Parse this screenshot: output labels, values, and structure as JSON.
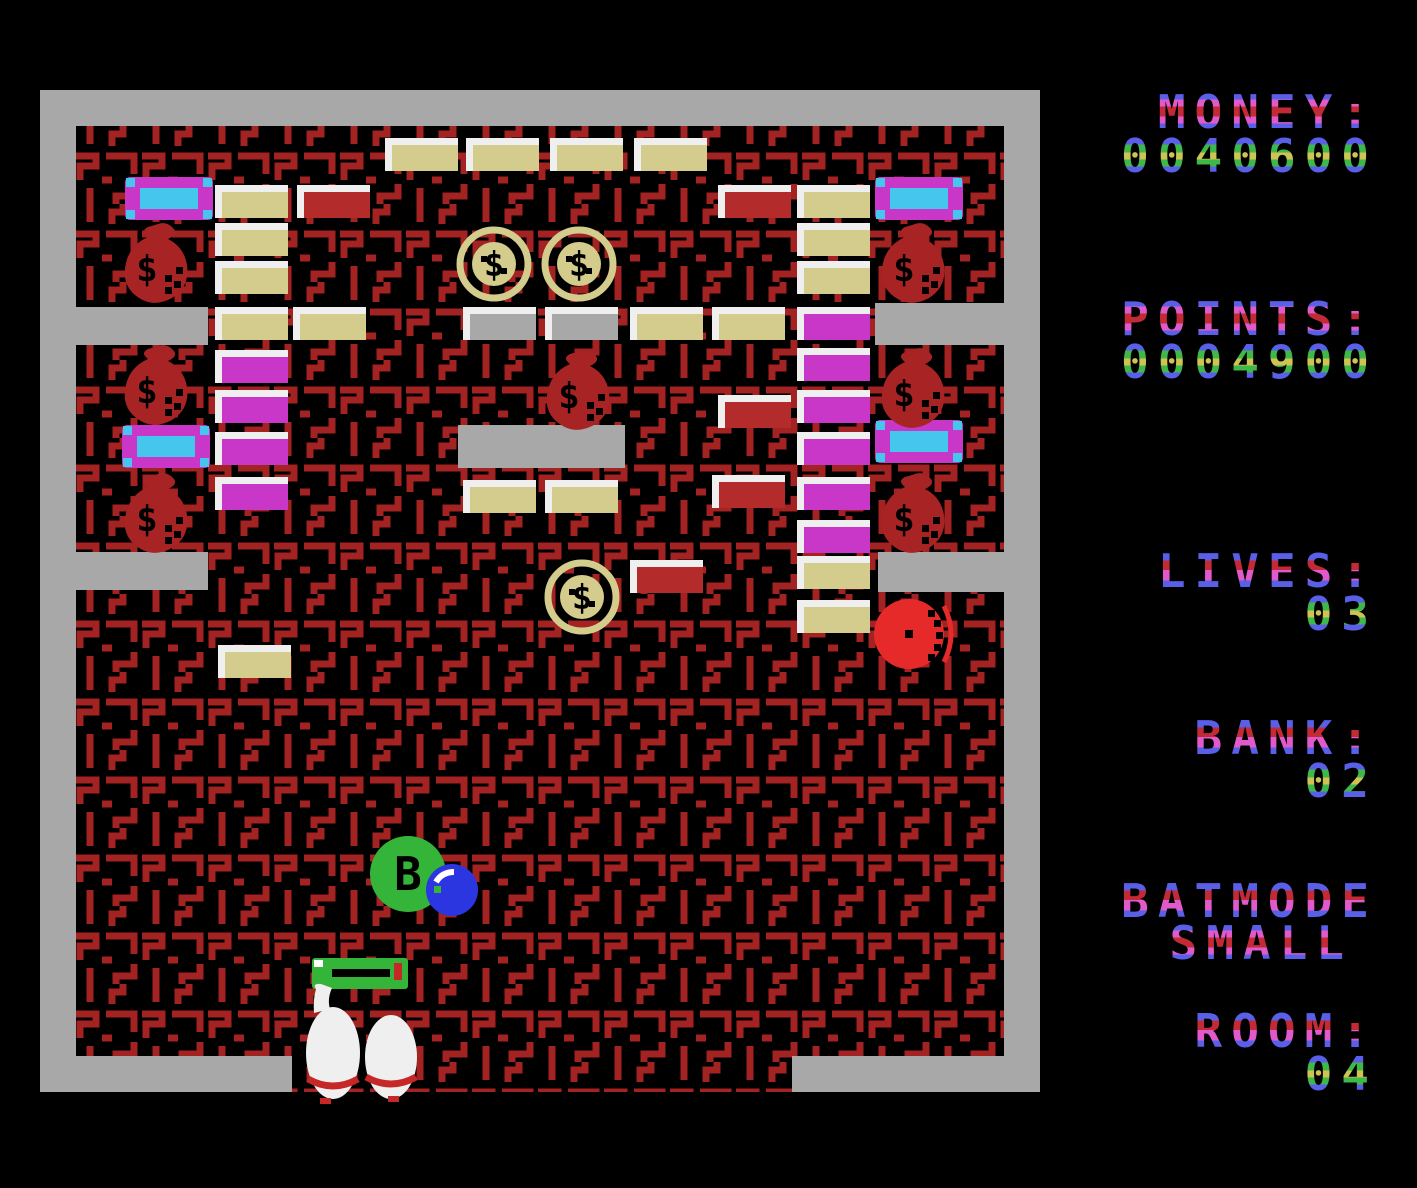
{
  "hud": {
    "money": {
      "label": "MONEY:",
      "value": "0040600"
    },
    "points": {
      "label": "POINTS:",
      "value": "0004900"
    },
    "lives": {
      "label": "LIVES:",
      "value": "03"
    },
    "bank": {
      "label": "BANK:",
      "value": "02"
    },
    "batmode": {
      "label": "BATMODE",
      "value": "SMALL"
    },
    "room": {
      "label": "ROOM:",
      "value": "04"
    }
  },
  "sprite_glyphs": {
    "coin_symbol": "$",
    "money_bag_symbol": "$",
    "bonus_ball_letter": "B"
  },
  "colors": {
    "background": "#000000",
    "wall_gray": "#A8A8A8",
    "maze_red": "#A32222",
    "brick_cream": "#D3CC8C",
    "brick_gray": "#A8A8A8",
    "brick_red": "#B32B2B",
    "brick_magenta": "#C837C8",
    "brick_highlight": "#EFEFEF",
    "sprite_dark_red": "#A82424",
    "sprite_bright_red": "#E62A2A",
    "sprite_green": "#35B43A",
    "sprite_blue": "#2B35E0",
    "sprite_cyan": "#45C6EC",
    "sprite_white": "#EFEFEF",
    "sprite_sole_red": "#C62828",
    "text_blue": "#5A5FE8",
    "text_pink": "#E05ACB",
    "text_dark_red": "#C22B35",
    "text_green": "#3EB849",
    "text_yellow": "#CFC353"
  },
  "playfield": {
    "walls": [
      {
        "name": "wall-top",
        "x": 0,
        "y": 0,
        "w": 1000,
        "h": 36
      },
      {
        "name": "wall-left",
        "x": 0,
        "y": 0,
        "w": 36,
        "h": 1002
      },
      {
        "name": "wall-right",
        "x": 964,
        "y": 0,
        "w": 36,
        "h": 1002
      },
      {
        "name": "wall-bottom-left",
        "x": 0,
        "y": 966,
        "w": 252,
        "h": 36
      },
      {
        "name": "wall-bottom-right",
        "x": 752,
        "y": 966,
        "w": 248,
        "h": 36
      },
      {
        "name": "ledge-upper-left",
        "x": 36,
        "y": 217,
        "w": 132,
        "h": 38
      },
      {
        "name": "ledge-upper-right",
        "x": 835,
        "y": 213,
        "w": 129,
        "h": 42
      },
      {
        "name": "ledge-lower-left",
        "x": 36,
        "y": 462,
        "w": 132,
        "h": 38
      },
      {
        "name": "ledge-lower-right",
        "x": 838,
        "y": 462,
        "w": 126,
        "h": 40
      }
    ],
    "bricks": [
      {
        "x": 345,
        "y": 48,
        "color": "cream"
      },
      {
        "x": 426,
        "y": 48,
        "color": "cream"
      },
      {
        "x": 510,
        "y": 48,
        "color": "cream"
      },
      {
        "x": 594,
        "y": 48,
        "color": "cream"
      },
      {
        "x": 175,
        "y": 95,
        "color": "cream"
      },
      {
        "x": 257,
        "y": 95,
        "color": "red"
      },
      {
        "x": 678,
        "y": 95,
        "color": "red"
      },
      {
        "x": 757,
        "y": 95,
        "color": "cream"
      },
      {
        "x": 175,
        "y": 133,
        "color": "cream"
      },
      {
        "x": 757,
        "y": 133,
        "color": "cream"
      },
      {
        "x": 175,
        "y": 171,
        "color": "cream"
      },
      {
        "x": 757,
        "y": 171,
        "color": "cream"
      },
      {
        "x": 175,
        "y": 217,
        "color": "cream"
      },
      {
        "x": 253,
        "y": 217,
        "color": "cream"
      },
      {
        "x": 423,
        "y": 217,
        "color": "gray"
      },
      {
        "x": 505,
        "y": 217,
        "color": "gray"
      },
      {
        "x": 590,
        "y": 217,
        "color": "cream"
      },
      {
        "x": 672,
        "y": 217,
        "color": "cream"
      },
      {
        "x": 757,
        "y": 217,
        "color": "magenta"
      },
      {
        "x": 175,
        "y": 260,
        "color": "magenta"
      },
      {
        "x": 757,
        "y": 258,
        "color": "magenta"
      },
      {
        "x": 175,
        "y": 300,
        "color": "magenta"
      },
      {
        "x": 678,
        "y": 305,
        "color": "red"
      },
      {
        "x": 757,
        "y": 300,
        "color": "magenta"
      },
      {
        "x": 175,
        "y": 342,
        "color": "magenta"
      },
      {
        "x": 757,
        "y": 342,
        "color": "magenta"
      },
      {
        "x": 418,
        "y": 335,
        "w": 167,
        "h": 43,
        "color": "gray",
        "hl": false
      },
      {
        "x": 175,
        "y": 387,
        "color": "magenta"
      },
      {
        "x": 423,
        "y": 390,
        "color": "cream"
      },
      {
        "x": 505,
        "y": 390,
        "color": "cream"
      },
      {
        "x": 672,
        "y": 385,
        "color": "red"
      },
      {
        "x": 757,
        "y": 387,
        "color": "magenta"
      },
      {
        "x": 757,
        "y": 430,
        "color": "magenta"
      },
      {
        "x": 590,
        "y": 470,
        "color": "red"
      },
      {
        "x": 757,
        "y": 466,
        "color": "cream"
      },
      {
        "x": 757,
        "y": 510,
        "color": "cream"
      },
      {
        "x": 178,
        "y": 555,
        "color": "cream"
      }
    ],
    "sprites": [
      {
        "type": "capsule",
        "x": 85,
        "y": 87
      },
      {
        "type": "capsule",
        "x": 835,
        "y": 87
      },
      {
        "type": "capsule",
        "x": 82,
        "y": 335
      },
      {
        "type": "capsule",
        "x": 835,
        "y": 330
      },
      {
        "type": "moneybag",
        "x": 78,
        "y": 133
      },
      {
        "type": "moneybag",
        "x": 835,
        "y": 133
      },
      {
        "type": "moneybag",
        "x": 78,
        "y": 255
      },
      {
        "type": "moneybag",
        "x": 835,
        "y": 258
      },
      {
        "type": "moneybag",
        "x": 500,
        "y": 260
      },
      {
        "type": "moneybag",
        "x": 78,
        "y": 383
      },
      {
        "type": "moneybag",
        "x": 835,
        "y": 383
      },
      {
        "type": "coin",
        "x": 415,
        "y": 135
      },
      {
        "type": "coin",
        "x": 500,
        "y": 135
      },
      {
        "type": "coin",
        "x": 503,
        "y": 468
      },
      {
        "type": "redball",
        "x": 833,
        "y": 502
      },
      {
        "type": "greenball",
        "x": 328,
        "y": 743
      },
      {
        "type": "blueball",
        "x": 384,
        "y": 772
      },
      {
        "type": "paddle",
        "x": 272,
        "y": 865
      },
      {
        "type": "boots",
        "x": 256,
        "y": 893
      }
    ]
  }
}
